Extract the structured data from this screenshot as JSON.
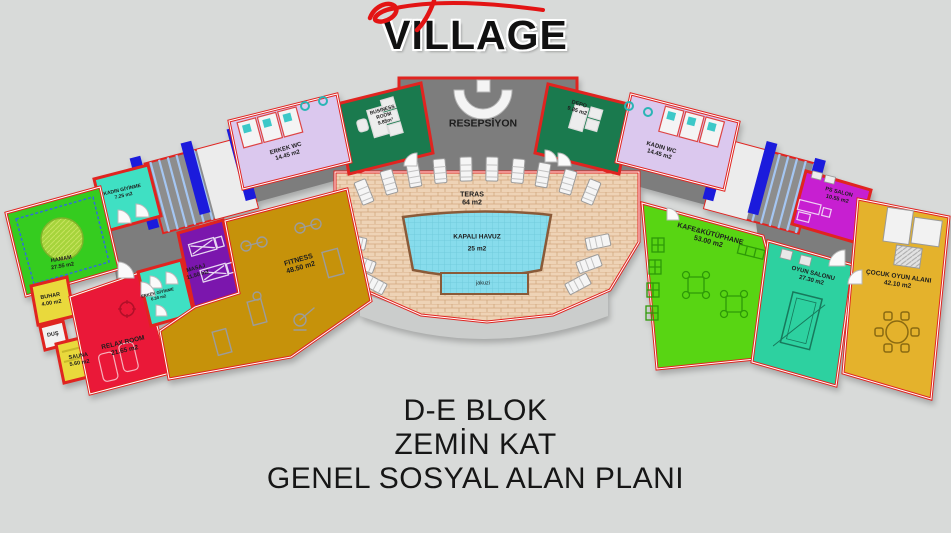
{
  "logo": {
    "title": "VILLAGE",
    "script_color": "#e31414"
  },
  "plan": {
    "rooms": {
      "resepsiyon": {
        "name": "RESEPSİYON"
      },
      "business_room": {
        "name": "BUSINESS ROOM",
        "area": "9.85m²"
      },
      "erkek_wc": {
        "name": "ERKEK WC",
        "area": "14.45 m2"
      },
      "kadin_giyinme": {
        "name": "KADIN GİYİNME",
        "area": "7.25 m2"
      },
      "hamam": {
        "name": "HAMAM",
        "area": "27.55 m2"
      },
      "buhar": {
        "name": "BUHAR",
        "area": "4.00 m2"
      },
      "dus": {
        "name": "DUŞ"
      },
      "sauna": {
        "name": "SAUNA",
        "area": "5.60 m2"
      },
      "relax_room": {
        "name": "RELAX ROOM",
        "area": "21.65 m2"
      },
      "erkek_giyinme": {
        "name": "ERKEK GİYİNME",
        "area": "6.30 m2"
      },
      "masaj": {
        "name": "MASAJ",
        "area": "11.50 m2"
      },
      "fitness": {
        "name": "FITNESS",
        "area": "48.50 m2"
      },
      "teras": {
        "name": "TERAS",
        "area": "64 m2"
      },
      "kapali_havuz": {
        "name": "KAPALI HAVUZ",
        "area": "25 m2"
      },
      "jakuzi": {
        "name": "jakuzi"
      },
      "depo": {
        "name": "DEPO",
        "area": "9.85 m2"
      },
      "kadin_wc": {
        "name": "KADIN WC",
        "area": "14.45 m2"
      },
      "ps_salon": {
        "name": "PS SALON",
        "area": "10.55 m2"
      },
      "kafe_kutuphane": {
        "name": "KAFE&KÜTÜPHANE",
        "area": "53.00 m2"
      },
      "oyun_salonu": {
        "name": "OYUN SALONU",
        "area": "27.30 m2"
      },
      "cocuk_oyun_alani": {
        "name": "ÇOCUK OYUN ALANI",
        "area": "42.10 m2"
      }
    },
    "footer": {
      "line1": "D-E BLOK",
      "line2": "ZEMİN KAT",
      "line3": "GENEL SOSYAL ALAN PLANI"
    }
  },
  "colors": {
    "background": "#d8dad9",
    "wall_red": "#e02420",
    "corridor_gray": "#7d7d7d",
    "office_green": "#1a7a4e",
    "wc_lavender": "#dbc8ee",
    "changing_turquoise": "#3fe0c3",
    "hamam_green": "#35cc1f",
    "steam_yellow": "#e9d93c",
    "relax_crimson": "#ea1838",
    "masaj_purple": "#7b16ad",
    "fitness_gold": "#c6920a",
    "terrace_brick": "#eed3b6",
    "pool_cyan": "#87dcec",
    "cafe_green": "#58d513",
    "game_teal": "#2dd1a0",
    "kids_gold": "#e4b22c",
    "ps_magenta": "#c71fd1",
    "elevator_blue": "#1b1bdc",
    "stair_blue": "#a5c6f2"
  }
}
